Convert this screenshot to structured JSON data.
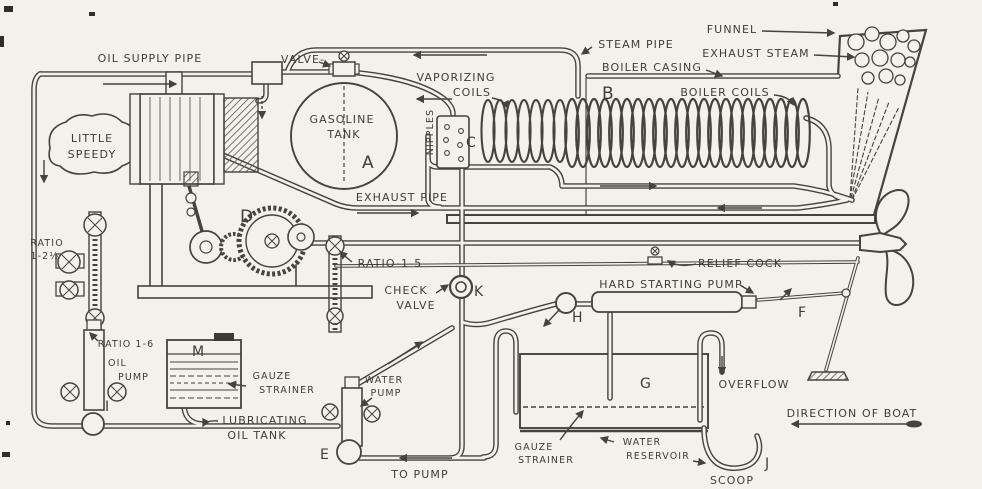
{
  "colors": {
    "ink": "#45433c",
    "paper": "#f3f1e9"
  },
  "labels": {
    "oil_supply_pipe": "OIL SUPPLY PIPE",
    "little_1": "LITTLE",
    "little_2": "SPEEDY",
    "valve": "VALVE-",
    "gasoline": "GASOLINE",
    "tank": "TANK",
    "vaporizing": "VAPORIZING",
    "coils": "COILS",
    "nipples": "NIPPLES",
    "steam_pipe": "STEAM PIPE",
    "boiler_casing": "BOILER CASING",
    "boiler_coils": "BOILER COILS",
    "funnel": "FUNNEL",
    "exhaust_steam": "EXHAUST STEAM",
    "exhaust_pipe": "EXHAUST PIPE",
    "ratio_1_2_line1": "RATIO",
    "ratio_1_2_line2": "1-2½",
    "ratio_1_5": "RATIO-1-5",
    "check": "CHECK",
    "check_valve_2": "VALVE",
    "relief_cock": "RELIEF COCK",
    "hard_starting_pump": "HARD STARTING PUMP",
    "ratio_1_6": "RATIO 1-6",
    "oil": "OIL",
    "oil_pump": "PUMP",
    "gauze_1a": "GAUZE",
    "gauze_1b": "STRAINER",
    "lubricating": "LUBRICATING",
    "oil_tank": "OIL TANK",
    "water_1": "WATER",
    "pump_1": "PUMP",
    "to_pump": "TO PUMP",
    "gauze_2a": "GAUZE",
    "gauze_2b": "STRAINER",
    "water_2": "WATER",
    "reservoir": "RESERVOIR",
    "overflow": "OVERFLOW",
    "direction_of_boat": "DIRECTION OF BOAT",
    "scoop": "SCOOP"
  },
  "letters": {
    "a": "A",
    "b": "B",
    "c": "C",
    "d": "D",
    "e": "E",
    "f": "F",
    "g": "G",
    "h": "H",
    "i": "I",
    "j": "J",
    "k": "K",
    "m": "M"
  }
}
